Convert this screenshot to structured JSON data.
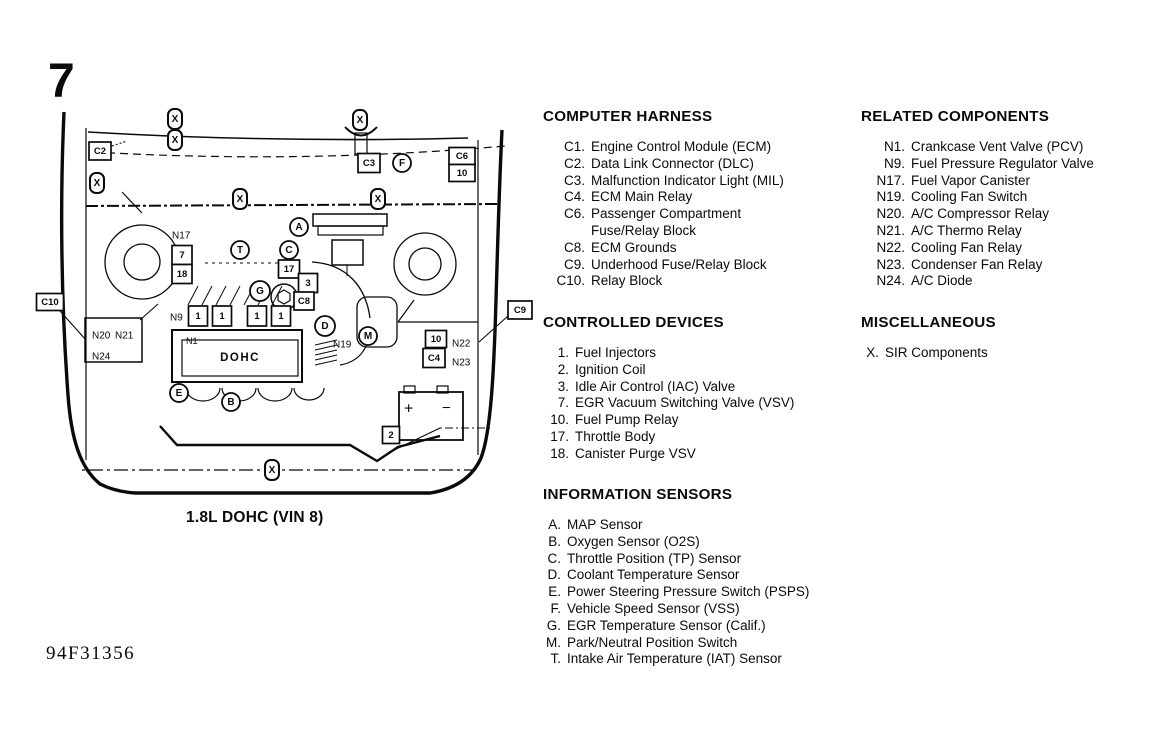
{
  "page": {
    "figure_number": "7",
    "caption": "1.8L DOHC (VIN 8)",
    "doc_code": "94F31356"
  },
  "sections": {
    "computer_harness": {
      "title": "COMPUTER HARNESS",
      "items": [
        {
          "num": "C1.",
          "text": "Engine Control Module (ECM)"
        },
        {
          "num": "C2.",
          "text": "Data Link Connector (DLC)"
        },
        {
          "num": "C3.",
          "text": "Malfunction Indicator Light (MIL)"
        },
        {
          "num": "C4.",
          "text": "ECM Main Relay"
        },
        {
          "num": "C6.",
          "text": "Passenger Compartment"
        },
        {
          "num": "",
          "text": "Fuse/Relay Block"
        },
        {
          "num": "C8.",
          "text": "ECM Grounds"
        },
        {
          "num": "C9.",
          "text": "Underhood Fuse/Relay Block"
        },
        {
          "num": "C10.",
          "text": "Relay Block"
        }
      ]
    },
    "controlled_devices": {
      "title": "CONTROLLED DEVICES",
      "items": [
        {
          "num": "1.",
          "text": "Fuel Injectors"
        },
        {
          "num": "2.",
          "text": "Ignition Coil"
        },
        {
          "num": "3.",
          "text": "Idle Air Control (IAC) Valve"
        },
        {
          "num": "7.",
          "text": "EGR Vacuum Switching Valve (VSV)"
        },
        {
          "num": "10.",
          "text": "Fuel Pump Relay"
        },
        {
          "num": "17.",
          "text": "Throttle Body"
        },
        {
          "num": "18.",
          "text": "Canister Purge VSV"
        }
      ]
    },
    "information_sensors": {
      "title": "INFORMATION SENSORS",
      "items": [
        {
          "num": "A.",
          "text": "MAP Sensor"
        },
        {
          "num": "B.",
          "text": "Oxygen Sensor (O2S)"
        },
        {
          "num": "C.",
          "text": "Throttle Position (TP) Sensor"
        },
        {
          "num": "D.",
          "text": "Coolant Temperature Sensor"
        },
        {
          "num": "E.",
          "text": "Power Steering Pressure Switch (PSPS)"
        },
        {
          "num": "F.",
          "text": "Vehicle Speed Sensor (VSS)"
        },
        {
          "num": "G.",
          "text": "EGR Temperature Sensor (Calif.)"
        },
        {
          "num": "M.",
          "text": "Park/Neutral Position Switch"
        },
        {
          "num": "T.",
          "text": "Intake Air Temperature (IAT) Sensor"
        }
      ]
    },
    "related_components": {
      "title": "RELATED COMPONENTS",
      "items": [
        {
          "num": "N1.",
          "text": "Crankcase Vent Valve (PCV)"
        },
        {
          "num": "N9.",
          "text": "Fuel Pressure Regulator Valve"
        },
        {
          "num": "N17.",
          "text": "Fuel Vapor Canister"
        },
        {
          "num": "N19.",
          "text": "Cooling Fan Switch"
        },
        {
          "num": "N20.",
          "text": "A/C Compressor Relay"
        },
        {
          "num": "N21.",
          "text": "A/C Thermo Relay"
        },
        {
          "num": "N22.",
          "text": "Cooling Fan Relay"
        },
        {
          "num": "N23.",
          "text": "Condenser Fan Relay"
        },
        {
          "num": "N24.",
          "text": "A/C Diode"
        }
      ]
    },
    "miscellaneous": {
      "title": "MISCELLANEOUS",
      "items": [
        {
          "num": "X.",
          "text": "SIR Components"
        }
      ]
    }
  },
  "diagram": {
    "engine_label": "DOHC",
    "x_symbol": "X",
    "circle_callouts": [
      {
        "label": "A",
        "x": 299,
        "y": 227
      },
      {
        "label": "B",
        "x": 231,
        "y": 402
      },
      {
        "label": "C",
        "x": 289,
        "y": 250
      },
      {
        "label": "D",
        "x": 325,
        "y": 326,
        "r": 10
      },
      {
        "label": "E",
        "x": 179,
        "y": 393
      },
      {
        "label": "F",
        "x": 402,
        "y": 163
      },
      {
        "label": "G",
        "x": 260,
        "y": 291,
        "r": 10
      },
      {
        "label": "M",
        "x": 368,
        "y": 336
      },
      {
        "label": "T",
        "x": 240,
        "y": 250
      }
    ],
    "x_callouts": [
      {
        "x": 175,
        "y": 119
      },
      {
        "x": 175,
        "y": 140
      },
      {
        "x": 97,
        "y": 183
      },
      {
        "x": 360,
        "y": 120
      },
      {
        "x": 240,
        "y": 199
      },
      {
        "x": 378,
        "y": 199
      },
      {
        "x": 272,
        "y": 470
      }
    ],
    "box_callouts": [
      {
        "label": "C2",
        "x": 100,
        "y": 151,
        "w": 22,
        "h": 18
      },
      {
        "label": "C3",
        "x": 369,
        "y": 163,
        "w": 22,
        "h": 19
      },
      {
        "label": "C6",
        "x": 462,
        "y": 156,
        "w": 26,
        "h": 17
      },
      {
        "label": "10",
        "x": 462,
        "y": 173,
        "w": 26,
        "h": 17
      },
      {
        "label": "C10",
        "x": 50,
        "y": 302,
        "w": 27,
        "h": 17
      },
      {
        "label": "C9",
        "x": 520,
        "y": 310,
        "w": 24,
        "h": 18
      },
      {
        "label": "7",
        "x": 182,
        "y": 255,
        "w": 20,
        "h": 19
      },
      {
        "label": "18",
        "x": 182,
        "y": 274,
        "w": 20,
        "h": 19
      },
      {
        "label": "17",
        "x": 289,
        "y": 269,
        "w": 21,
        "h": 18
      },
      {
        "label": "3",
        "x": 308,
        "y": 283,
        "w": 19,
        "h": 19
      },
      {
        "label": "C8",
        "x": 304,
        "y": 301,
        "w": 20,
        "h": 18
      },
      {
        "label": "1",
        "x": 198,
        "y": 316,
        "w": 19,
        "h": 20
      },
      {
        "label": "1",
        "x": 222,
        "y": 316,
        "w": 19,
        "h": 20
      },
      {
        "label": "1",
        "x": 257,
        "y": 316,
        "w": 19,
        "h": 20
      },
      {
        "label": "1",
        "x": 281,
        "y": 316,
        "w": 19,
        "h": 20
      },
      {
        "label": "10",
        "x": 436,
        "y": 339,
        "w": 21,
        "h": 17
      },
      {
        "label": "C4",
        "x": 434,
        "y": 358,
        "w": 22,
        "h": 19
      },
      {
        "label": "2",
        "x": 391,
        "y": 435,
        "w": 17,
        "h": 17
      }
    ],
    "text_labels": [
      {
        "t": "N17",
        "x": 172,
        "y": 236,
        "fs": 10
      },
      {
        "t": "N9",
        "x": 170,
        "y": 318,
        "fs": 10
      },
      {
        "t": "N1",
        "x": 186,
        "y": 341,
        "fs": 9
      },
      {
        "t": "N19",
        "x": 333,
        "y": 345,
        "fs": 10
      },
      {
        "t": "N20",
        "x": 92,
        "y": 336,
        "fs": 10
      },
      {
        "t": "N21",
        "x": 115,
        "y": 336,
        "fs": 10
      },
      {
        "t": "N24",
        "x": 92,
        "y": 357,
        "fs": 10
      },
      {
        "t": "N22",
        "x": 452,
        "y": 344,
        "fs": 10
      },
      {
        "t": "N23",
        "x": 452,
        "y": 363,
        "fs": 10
      },
      {
        "t": "+",
        "x": 404,
        "y": 409,
        "fs": 16
      },
      {
        "t": "−",
        "x": 442,
        "y": 408,
        "fs": 15
      }
    ]
  }
}
